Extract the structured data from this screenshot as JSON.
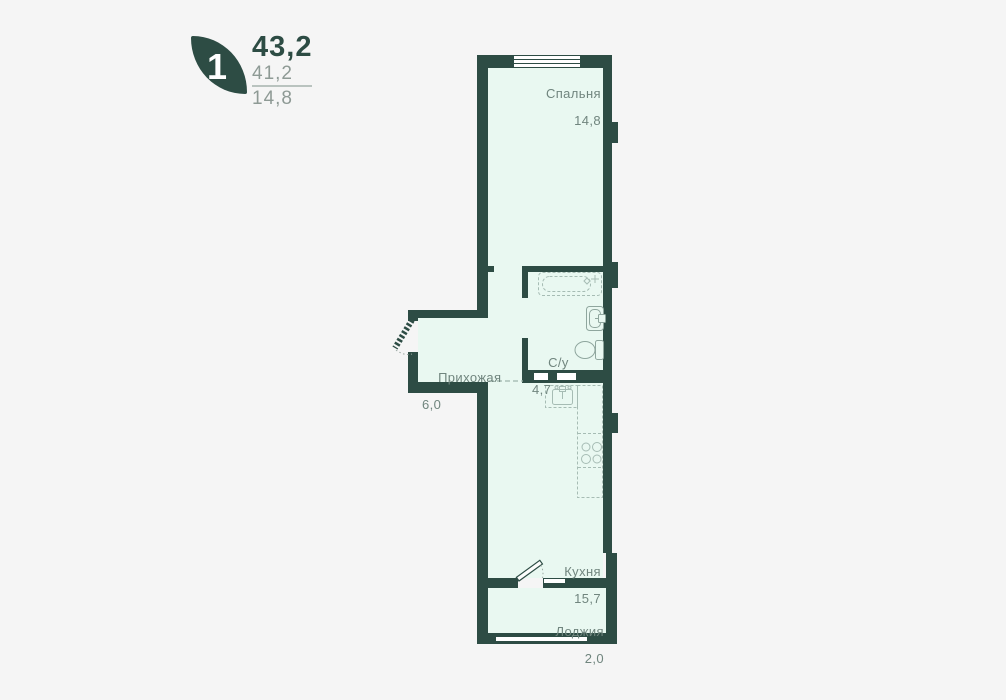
{
  "legend": {
    "rooms_badge": "1",
    "total_area": "43,2",
    "living_area": "41,2",
    "extra_area": "14,8"
  },
  "rooms": {
    "bedroom": {
      "label": "Спальня",
      "area": "14,8"
    },
    "hallway": {
      "label": "Прихожая",
      "area": "6,0"
    },
    "bathroom": {
      "label": "С/у",
      "area": "4,7"
    },
    "kitchen": {
      "label": "Кухня",
      "area": "15,7"
    },
    "loggia": {
      "label": "Лоджия",
      "area": "2,0"
    }
  },
  "colors": {
    "wall": "#2d4c44",
    "floor": "#e9f8f1",
    "background": "#f5f5f5",
    "label_text": "#70857e",
    "muted_number": "#8e9a95",
    "fixture_line": "#a6bcb4"
  }
}
